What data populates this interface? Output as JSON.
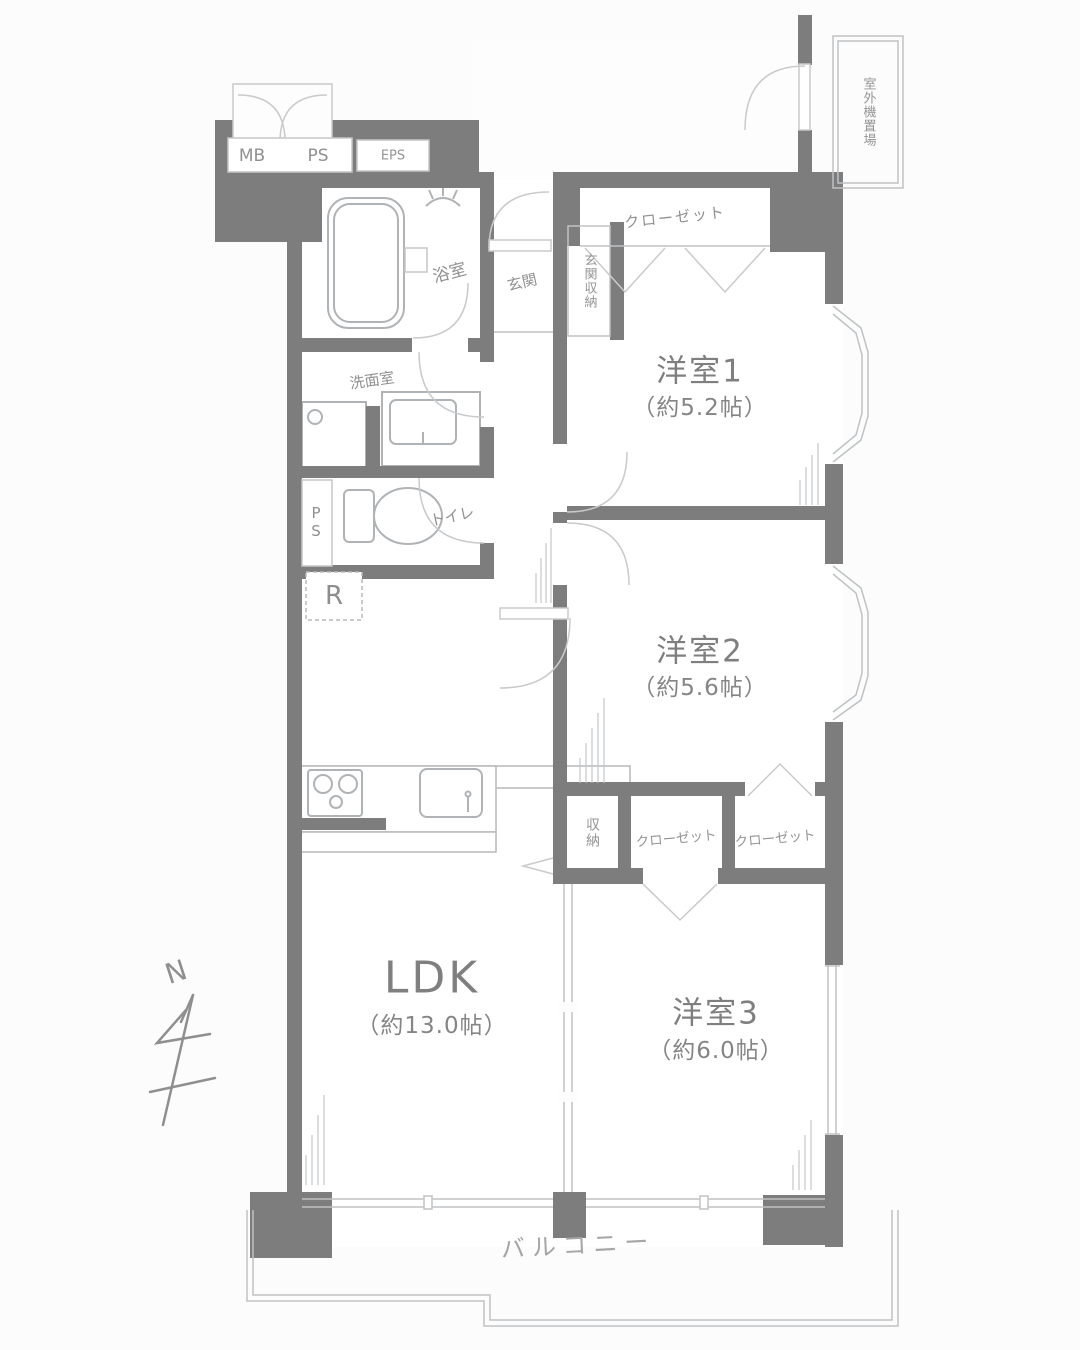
{
  "plan": {
    "title": "apartment-floorplan",
    "rooms": [
      {
        "id": "room1",
        "label": "洋室1",
        "size": "（約5.2帖）"
      },
      {
        "id": "room2",
        "label": "洋室2",
        "size": "（約5.6帖）"
      },
      {
        "id": "room3",
        "label": "洋室3",
        "size": "（約6.0帖）"
      },
      {
        "id": "ldk",
        "label": "LDK",
        "size": "（約13.0帖）"
      }
    ],
    "areas": {
      "bath": "浴室",
      "washroom": "洗面室",
      "toilet": "トイレ",
      "genkan": "玄関",
      "genkan_storage": "玄関収納",
      "closet_room1": "クローゼット",
      "storage": "収納",
      "closet_a": "クローゼット",
      "closet_b": "クローゼット",
      "balcony": "バルコニー",
      "outdoor_unit": "室外機置場",
      "refrigerator": "R"
    },
    "utility": {
      "mb": "MB",
      "ps": "PS",
      "eps": "EPS",
      "ps_shaft": "PS"
    },
    "compass": {
      "north": "N"
    },
    "colors": {
      "wall": "#7d7d7d",
      "line": "#b9bcbe",
      "text": "#8d8d8d",
      "bg": "#fcfcfc"
    }
  }
}
